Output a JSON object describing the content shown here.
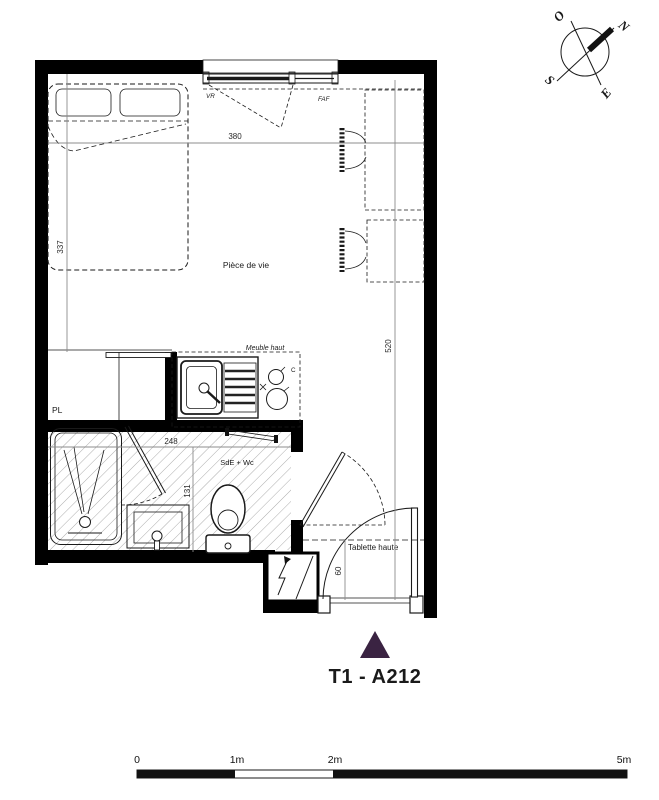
{
  "plan_title": "T1 - A212",
  "rooms": {
    "living": "Pièce de vie",
    "bathroom": "SdE + Wc",
    "closet": "PL"
  },
  "annotations": {
    "kitchen_upper": "Meuble haut",
    "high_shelf": "Tablette haute",
    "window_shutter": "VR",
    "window_type": "FAF",
    "cooktop": "C"
  },
  "dimensions_cm": {
    "living_width": "380",
    "bed_wall": "337",
    "living_depth": "520",
    "bath_width": "248",
    "bath_depth": "131",
    "entry": "60"
  },
  "compass": {
    "north": "N",
    "west": "O",
    "south": "S",
    "east": "E"
  },
  "scale_bar": {
    "ticks": [
      "0",
      "1m",
      "2m",
      "5m"
    ]
  },
  "colors": {
    "accent": "#3a2342",
    "walls": "#000000",
    "dimensions": "#8c8c8c"
  }
}
